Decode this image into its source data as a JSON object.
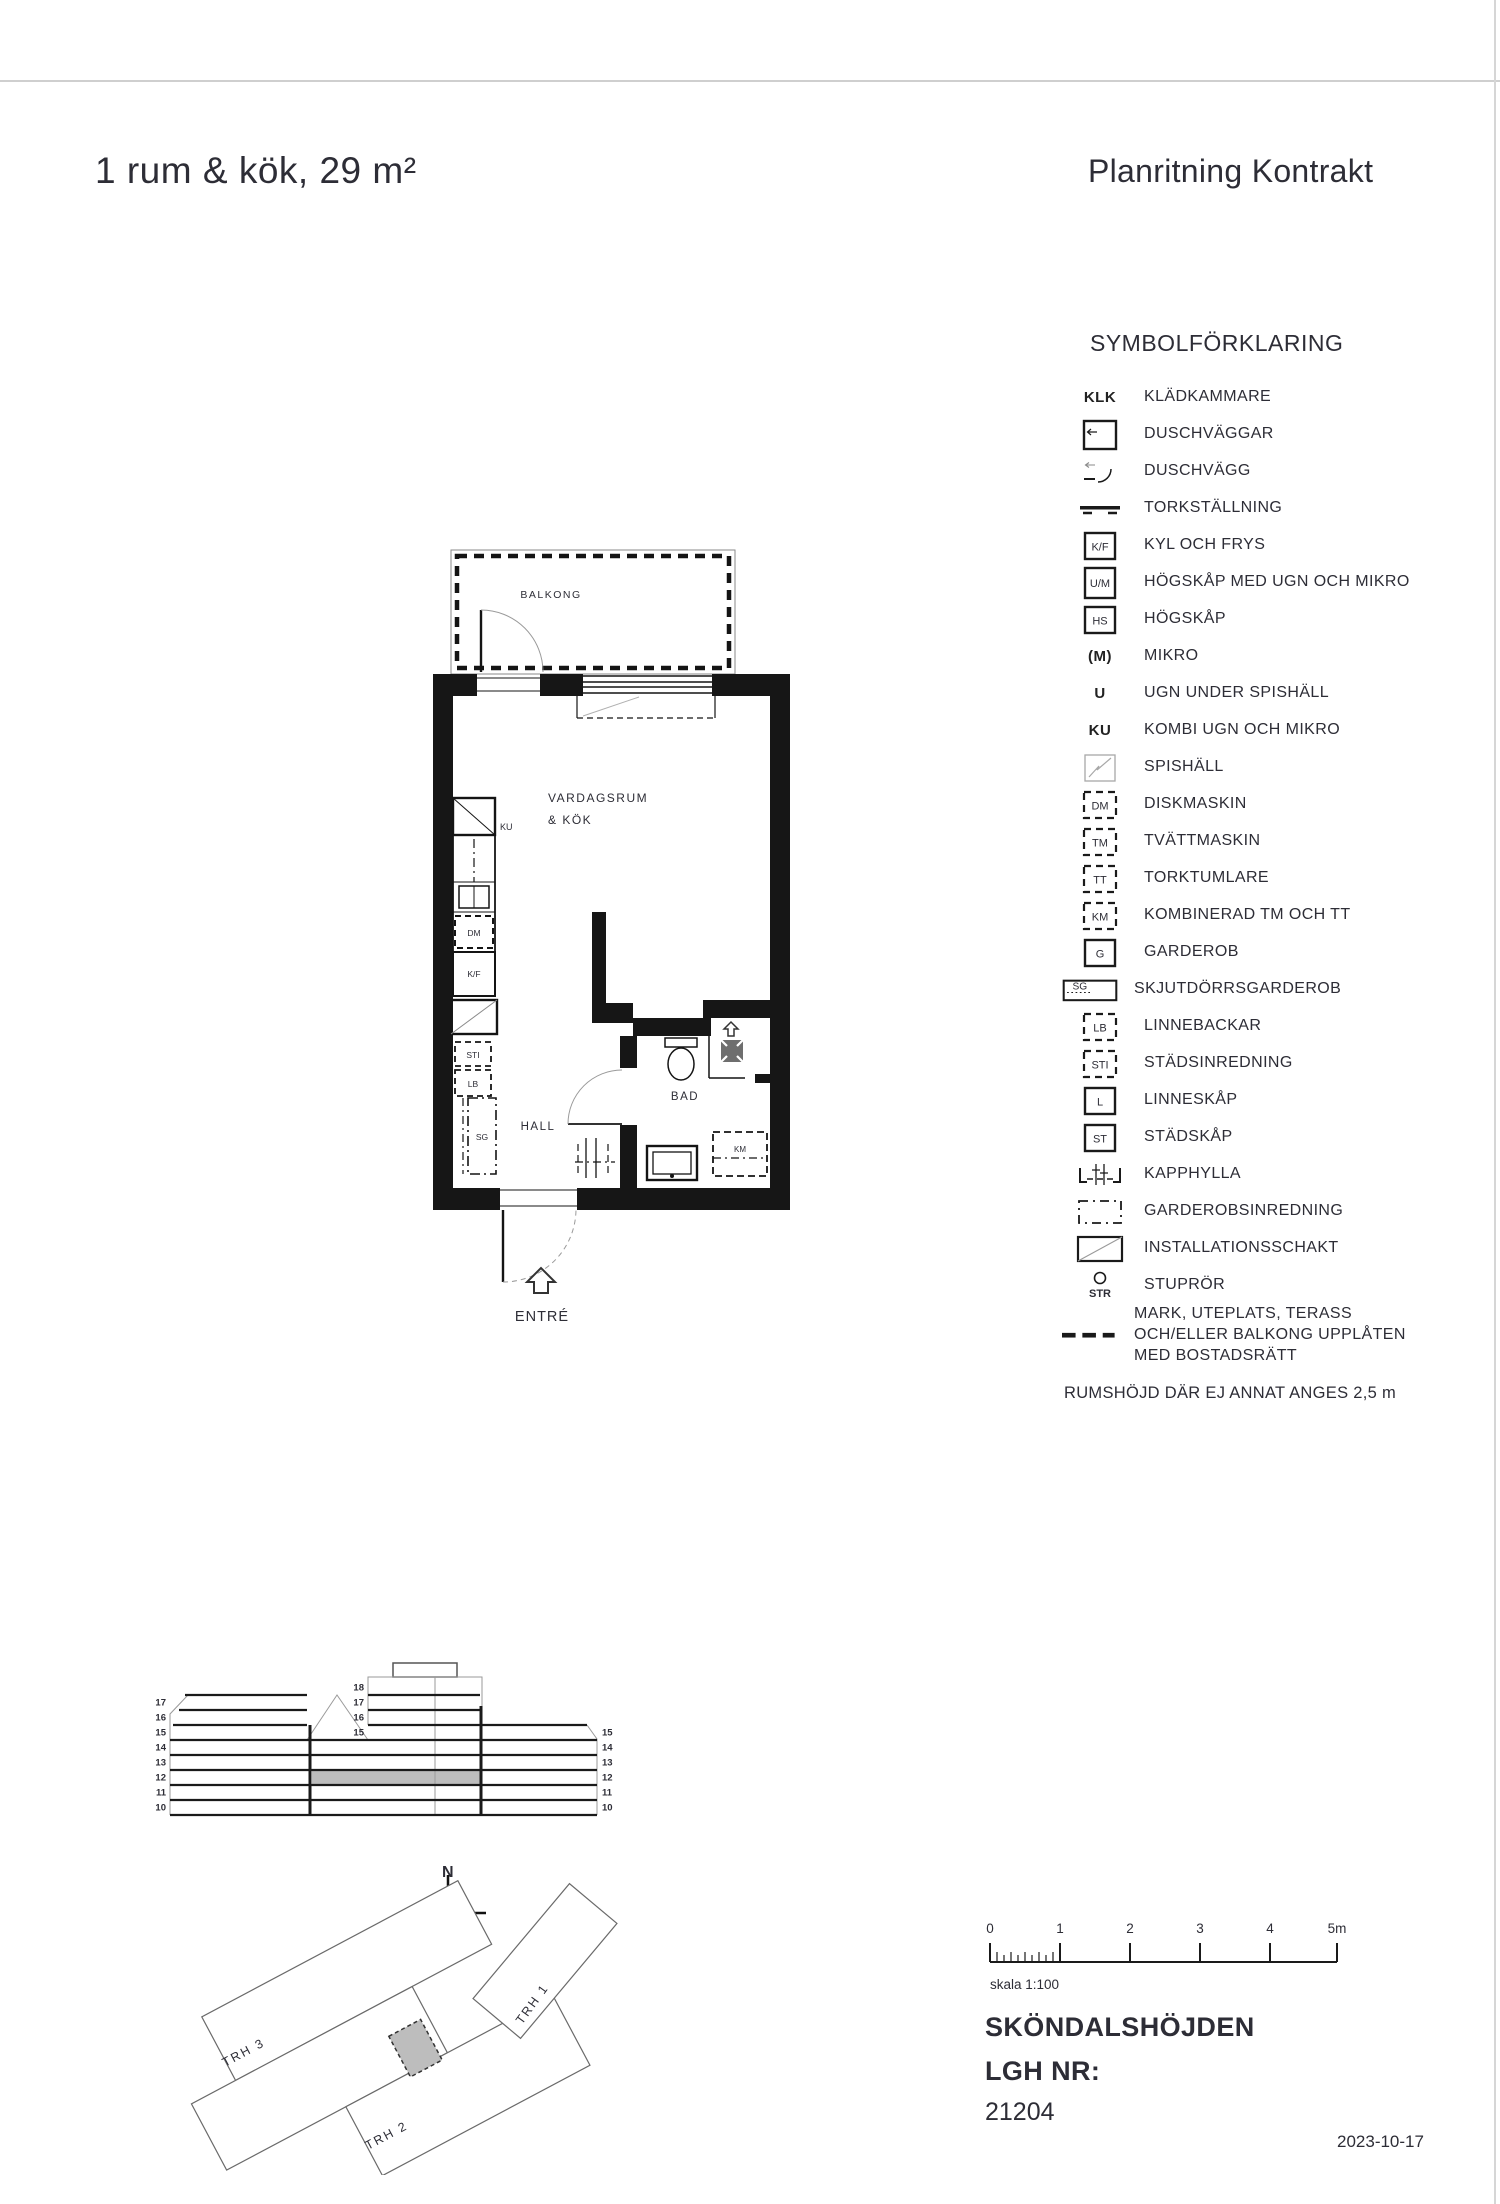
{
  "header": {
    "title": "1 rum & kök, 29 m²",
    "doc_title": "Planritning Kontrakt"
  },
  "legend": {
    "title": "SYMBOLFÖRKLARING",
    "items": [
      {
        "type": "code",
        "code": "KLK",
        "label": "KLÄDKAMMARE"
      },
      {
        "type": "shower-walls",
        "code": "",
        "label": "DUSCHVÄGGAR"
      },
      {
        "type": "shower-curve",
        "code": "",
        "label": "DUSCHVÄGG"
      },
      {
        "type": "drying-rack",
        "code": "",
        "label": "TORKSTÄLLNING"
      },
      {
        "type": "box",
        "code": "K/F",
        "label": "KYL OCH FRYS"
      },
      {
        "type": "box",
        "code": "U/M",
        "label": "HÖGSKÅP MED UGN OCH MIKRO"
      },
      {
        "type": "box",
        "code": "HS",
        "label": "HÖGSKÅP"
      },
      {
        "type": "code",
        "code": "(M)",
        "label": "MIKRO"
      },
      {
        "type": "code",
        "code": "U",
        "label": "UGN UNDER SPISHÄLL"
      },
      {
        "type": "code",
        "code": "KU",
        "label": "KOMBI UGN OCH MIKRO"
      },
      {
        "type": "box-diagonal-light",
        "code": "",
        "label": "SPISHÄLL"
      },
      {
        "type": "box-dashed",
        "code": "DM",
        "label": "DISKMASKIN"
      },
      {
        "type": "box-dashed",
        "code": "TM",
        "label": "TVÄTTMASKIN"
      },
      {
        "type": "box-dashed",
        "code": "TT",
        "label": "TORKTUMLARE"
      },
      {
        "type": "box-dashed",
        "code": "KM",
        "label": "KOMBINERAD TM OCH TT"
      },
      {
        "type": "box",
        "code": "G",
        "label": "GARDEROB"
      },
      {
        "type": "sliding-wardrobe",
        "code": "SG",
        "label": "SKJUTDÖRRSGARDEROB"
      },
      {
        "type": "box-dashed",
        "code": "LB",
        "label": "LINNEBACKAR"
      },
      {
        "type": "box-dashed",
        "code": "STI",
        "label": "STÄDSINREDNING"
      },
      {
        "type": "box",
        "code": "L",
        "label": "LINNESKÅP"
      },
      {
        "type": "box",
        "code": "ST",
        "label": "STÄDSKÅP"
      },
      {
        "type": "coat-rack",
        "code": "",
        "label": "KAPPHYLLA"
      },
      {
        "type": "wardrobe-interior",
        "code": "",
        "label": "GARDEROBSINREDNING"
      },
      {
        "type": "box-diagonal",
        "code": "",
        "label": "INSTALLATIONSSCHAKT"
      },
      {
        "type": "downpipe",
        "code": "STR",
        "label": "STUPRÖR"
      },
      {
        "type": "boundary-dashes",
        "code": "",
        "label": "MARK, UTEPLATS, TERASS OCH/ELLER BALKONG UPPLÅTEN MED BOSTADSRÄTT"
      }
    ],
    "note": "RUMSHÖJD DÄR EJ ANNAT ANGES 2,5 m"
  },
  "plan": {
    "labels": {
      "balcony": "BALKONG",
      "room_line1": "VARDAGSRUM",
      "room_line2": "& KÖK",
      "hall": "HALL",
      "bath": "BAD",
      "entrance": "ENTRÉ",
      "ku": "KU",
      "dm": "DM",
      "kf": "K/F",
      "sti": "STI",
      "lb": "LB",
      "sg": "SG",
      "km": "KM"
    }
  },
  "elevation": {
    "left_floors": [
      "17",
      "16",
      "15",
      "14",
      "13",
      "12",
      "11",
      "10"
    ],
    "middle_floors": [
      "18",
      "17",
      "16",
      "15"
    ],
    "right_floors": [
      "15",
      "14",
      "13",
      "12",
      "11",
      "10"
    ],
    "highlight_color": "#bdbdbd"
  },
  "site": {
    "north_label": "N",
    "trh1": "TRH 1",
    "trh2": "TRH 2",
    "trh3": "TRH 3"
  },
  "scalebar": {
    "ticks": [
      "0",
      "1",
      "2",
      "3",
      "4",
      "5m"
    ],
    "caption": "skala 1:100"
  },
  "footer": {
    "project": "SKÖNDALSHÖJDEN",
    "lgh_label": "LGH NR:",
    "lgh_number": "21204",
    "date": "2023-10-17"
  }
}
